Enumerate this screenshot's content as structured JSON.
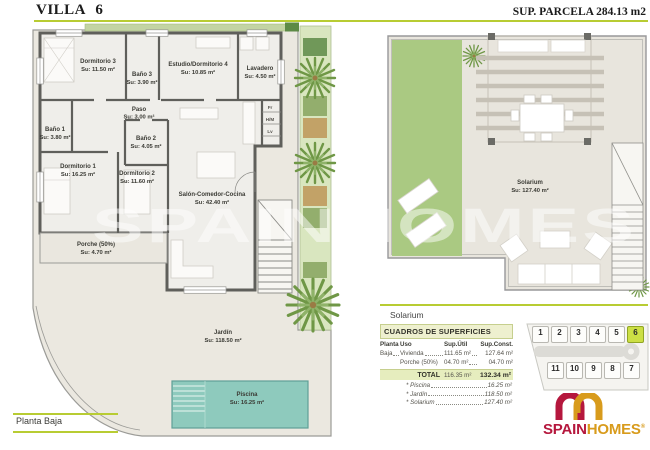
{
  "header": {
    "title": "VILLA 6",
    "parcela": "SUP. PARCELA 284.13 m2"
  },
  "colors": {
    "accent": "#b8cc33",
    "grass": "#aac982",
    "pool": "#8ecabd",
    "logo_red": "#b5173d",
    "logo_gold": "#d89b1c",
    "plot_highlight": "#ccdf45"
  },
  "watermark": "SPAINHOMES",
  "plan_footer": "Planta Baja",
  "rooms": {
    "dormitorio3": {
      "name": "Dormitorio 3",
      "area": "Su: 11.50 m²"
    },
    "bano3": {
      "name": "Baño 3",
      "area": "Su: 3.90 m²"
    },
    "estudio": {
      "name": "Estudio/Dormitorio 4",
      "area": "Su: 10.85 m²"
    },
    "lavadero": {
      "name": "Lavadero",
      "area": "Su: 4.50 m²"
    },
    "paso": {
      "name": "Paso",
      "area": "Su: 3.00 m²"
    },
    "bano1": {
      "name": "Baño 1",
      "area": "Su: 3.80 m²"
    },
    "bano2": {
      "name": "Baño 2",
      "area": "Su: 4.05 m²"
    },
    "dormitorio1": {
      "name": "Dormitorio 1",
      "area": "Su: 16.25 m²"
    },
    "dormitorio2": {
      "name": "Dormitorio 2",
      "area": "Su: 11.60 m²"
    },
    "salon": {
      "name": "Salón-Comedor-Cocina",
      "area": "Su: 42.40 m²"
    },
    "porche": {
      "name": "Porche (50%)",
      "area": "Su: 4.70 m²"
    },
    "jardin": {
      "name": "Jardín",
      "area": "Su: 118.50 m²"
    },
    "piscina": {
      "name": "Piscina",
      "area": "Su: 16.25 m²"
    },
    "solarium": {
      "name": "Solarium",
      "area": "Su: 127.40 m²"
    }
  },
  "appliances": {
    "fr": "Fr",
    "hm": "H/M",
    "lv": "Lv"
  },
  "solarium_section": {
    "label": "Solarium"
  },
  "surfaces_table": {
    "title": "CUADROS DE SUPERFICIES",
    "columns": {
      "planta": "Planta",
      "uso": "Uso",
      "util": "Sup.Útil",
      "const": "Sup.Const."
    },
    "rows": [
      {
        "planta": "Baja",
        "uso": "Vivienda",
        "util": "111.65 m²",
        "const": "127.64 m²"
      },
      {
        "planta": "",
        "uso": "Porche (50%)",
        "util": "04.70 m²",
        "const": "04.70 m²"
      }
    ],
    "total": {
      "label": "TOTAL",
      "util": "116.35 m²",
      "const": "132.34 m²"
    },
    "extras": [
      {
        "name": "* Piscina",
        "value": "16.25 m²"
      },
      {
        "name": "* Jardín",
        "value": "118.50 m²"
      },
      {
        "name": "* Solarium",
        "value": "127.40 m²"
      }
    ]
  },
  "plot_map": {
    "top_row": [
      "1",
      "2",
      "3",
      "4",
      "5",
      "6"
    ],
    "bottom_row": [
      "11",
      "10",
      "9",
      "8",
      "7"
    ],
    "highlighted_plot": "6"
  },
  "logo": {
    "spain": "SPAIN",
    "homes": "HOMES",
    "reg": "®"
  }
}
